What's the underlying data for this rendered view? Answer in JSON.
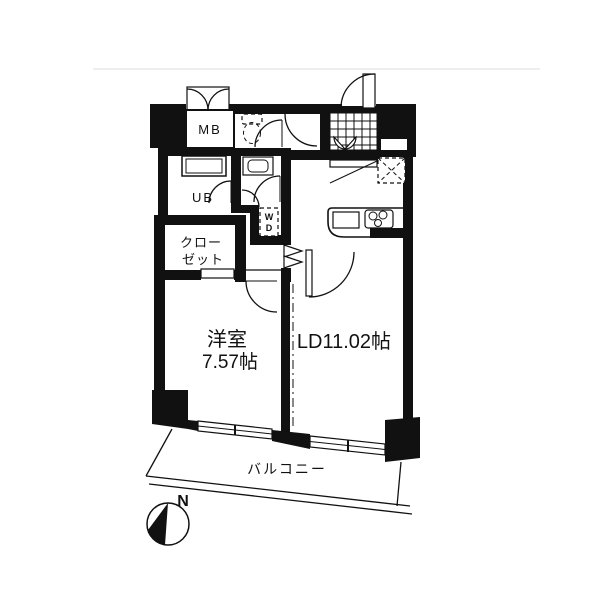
{
  "floorplan": {
    "labels": {
      "mb": "MB",
      "ub": "UB",
      "wd_w": "W",
      "wd_d": "D",
      "closet_line1": "クロー",
      "closet_line2": "ゼット",
      "western_room_name": "洋室",
      "western_room_size": "7.57帖",
      "living_dining": "LD11.02帖",
      "balcony": "バルコニー",
      "compass_north": "N"
    },
    "colors": {
      "wall": "#111111",
      "background": "#ffffff",
      "faint_line": "#dcdcdc"
    }
  }
}
